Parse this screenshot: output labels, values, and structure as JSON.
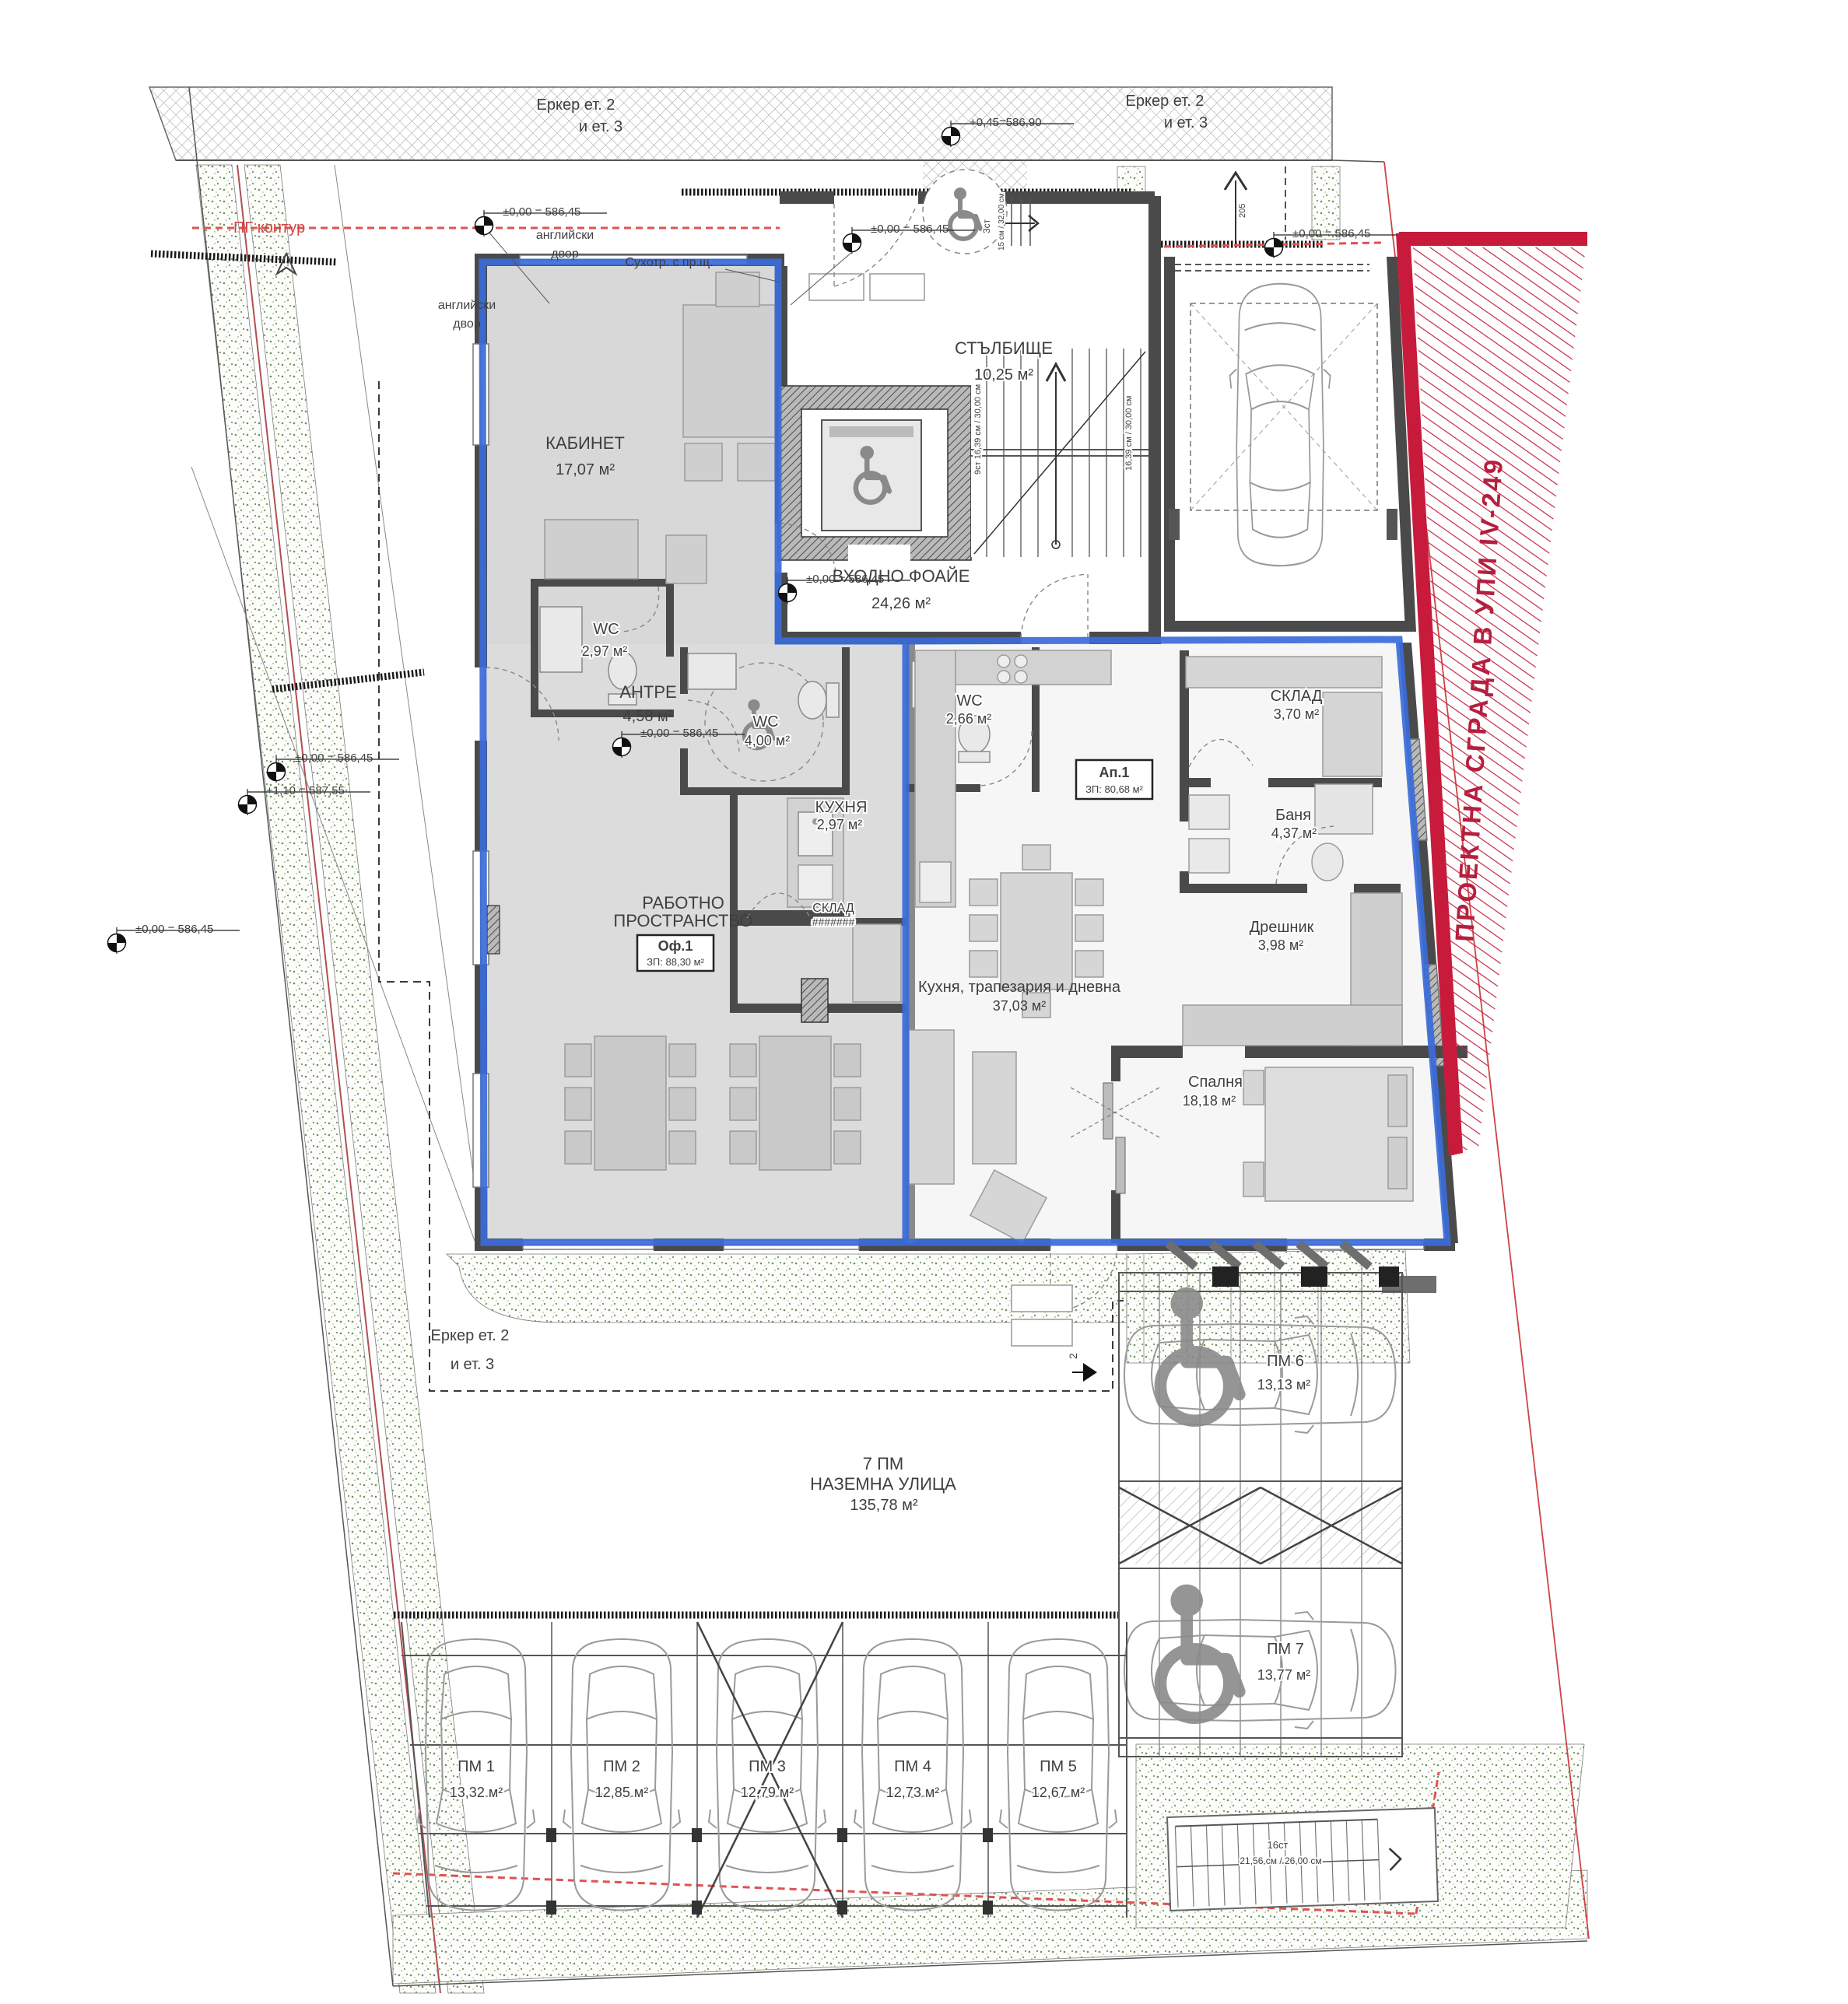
{
  "drawing": {
    "site": {
      "erker_line1": "Еркер ет. 2",
      "erker_line2": "и ет. 3",
      "pg_contour": "ПГ контур",
      "english_yard_line1": "английски",
      "english_yard_line2": "двор",
      "suhotr_note": "Сухотр. с пр.щ.",
      "project_boundary": "ПРОЕКТНА СГРАДА В УПИ IV-249",
      "section_number": "2",
      "ramp_width": "205"
    },
    "levels": {
      "zero": "±0,00 = 586,45",
      "plus_045": "+0,45=586,90",
      "plus_110": "+1,10 = 587,55"
    },
    "stairs": {
      "entry_steps": "3ст",
      "entry_steps_dim": "15 см / 32,00 см",
      "flight_note": "9ст  16,39 см / 30,00 см",
      "flight_note_right": "16,39 см / 30,00 см",
      "external_steps": "16ст",
      "external_steps_dim": "21,56 см / 26,00 см"
    },
    "rooms": {
      "stairwell": {
        "name": "СТЪЛБИЩЕ",
        "area": "10,25 м²"
      },
      "foyer": {
        "name": "ВХОДНО ФОАЙЕ",
        "area": "24,26 м²"
      },
      "cabinet": {
        "name": "КАБИНЕТ",
        "area": "17,07 м²"
      },
      "wc_cabinet": {
        "name": "WC",
        "area": "2,97 м²"
      },
      "antre": {
        "name": "АНТРЕ",
        "area": "4,58 м²"
      },
      "wc_accessible": {
        "name": "WC",
        "area": "4,00 м²"
      },
      "wc_apartment": {
        "name": "WC",
        "area": "2,66 м²"
      },
      "kitchen_niche": {
        "name": "КУХНЯ",
        "area": "2,97 м²"
      },
      "work_space": {
        "line1": "РАБОТНО",
        "line2": "ПРОСТРАНСТВО",
        "area": "40,34 м²"
      },
      "storage_office": {
        "name": "СКЛАД",
        "area": "#######"
      },
      "storage_apartment": {
        "name": "СКЛАД",
        "area": "3,70 м²"
      },
      "bathroom": {
        "name": "Баня",
        "area": "4,37 м²"
      },
      "dressing": {
        "name": "Дрешник",
        "area": "3,98 м²"
      },
      "living": {
        "name": "Кухня, трапезария и дневна",
        "area": "37,03 м²"
      },
      "bedroom": {
        "name": "Спалня",
        "area": "18,18 м²"
      }
    },
    "units": {
      "office": {
        "name": "Оф.1",
        "area": "ЗП: 88,30 м²"
      },
      "apartment": {
        "name": "Ап.1",
        "area": "ЗП: 80,68 м²"
      }
    },
    "street": {
      "line1": "7 ПМ",
      "line2": "НАЗЕМНА УЛИЦА",
      "area": "135,78 м²"
    },
    "parking": [
      {
        "name": "ПМ 1",
        "area": "13,32 м²"
      },
      {
        "name": "ПМ 2",
        "area": "12,85 м²"
      },
      {
        "name": "ПМ 3",
        "area": "12,79 м²"
      },
      {
        "name": "ПМ 4",
        "area": "12,73 м²"
      },
      {
        "name": "ПМ 5",
        "area": "12,67 м²"
      },
      {
        "name": "ПМ 6",
        "area": "13,13 м²"
      },
      {
        "name": "ПМ 7",
        "area": "13,77 м²"
      }
    ]
  }
}
